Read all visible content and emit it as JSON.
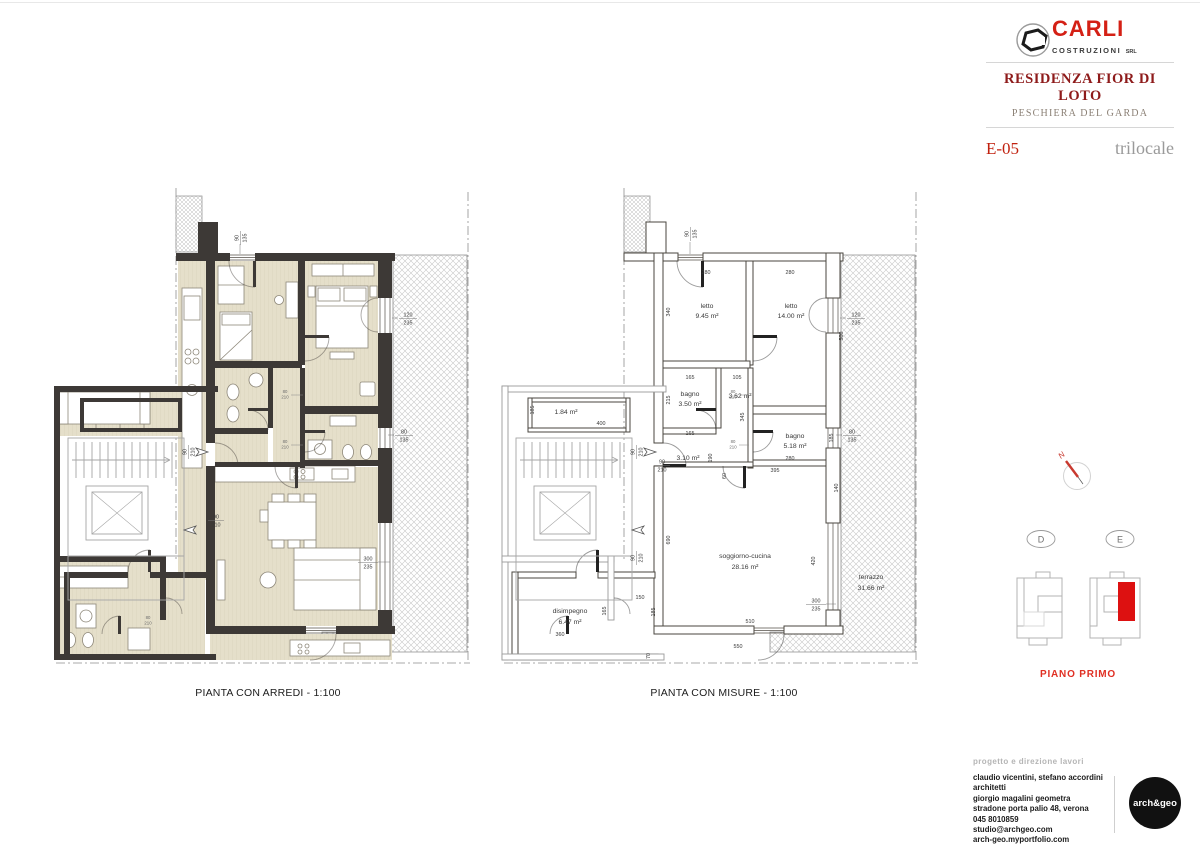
{
  "header": {
    "brand": "CARLI",
    "brand_sub": "COSTRUZIONI",
    "brand_suffix": "SRL",
    "residence": "RESIDENZA FIOR DI LOTO",
    "location": "PESCHIERA DEL GARDA",
    "unit_code": "E-05",
    "unit_type": "trilocale"
  },
  "plans": {
    "arredi": {
      "caption": "PIANTA CON ARREDI - 1:100"
    },
    "misure": {
      "caption": "PIANTA CON MISURE - 1:100",
      "rooms": [
        {
          "name": "letto",
          "area": "9.45 m²"
        },
        {
          "name": "letto",
          "area": "14.00 m²"
        },
        {
          "name": "bagno",
          "area": "3.50 m²"
        },
        {
          "name": "",
          "area": "3.62 m²"
        },
        {
          "name": "bagno",
          "area": "5.18 m²"
        },
        {
          "name": "",
          "area": "3.10 m²"
        },
        {
          "name": "",
          "area": "1.84 m²"
        },
        {
          "name": "soggiorno-cucina",
          "area": "28.16 m²"
        },
        {
          "name": "disimpegno",
          "area": "6.47 m²"
        },
        {
          "name": "terrazzo",
          "area": "31.66 m²"
        }
      ],
      "lin": {
        "letto1_w": "280",
        "letto2_w": "280",
        "letto1_d": "340",
        "letto2_d": "500",
        "bagno1_w": "165",
        "bagno1_d": "215",
        "corr_w": "105",
        "corr_d": "345",
        "bagno2_w": "280",
        "bagno2_d": "185",
        "hall_w": "165",
        "hall_d": "190",
        "seg60": "60",
        "living_top": "395",
        "living_d": "690",
        "living_w": "510",
        "living_ow": "550",
        "rip_d": "185",
        "rip_w": "400",
        "dis_w": "360",
        "dis_d": "165",
        "seg150": "150",
        "seg185": "185",
        "terr_d": "420",
        "seg140": "140",
        "seg70": "70"
      }
    }
  },
  "od": {
    "d90_135": [
      "90",
      "135"
    ],
    "d120_235": [
      "120",
      "235"
    ],
    "d80_135": [
      "80",
      "135"
    ],
    "d300_235": [
      "300",
      "235"
    ],
    "d90_210": [
      "90",
      "210"
    ],
    "d80_210": [
      "80",
      "210"
    ]
  },
  "keyplan": {
    "north": "N",
    "building_d": "D",
    "building_e": "E",
    "floor": "PIANO PRIMO"
  },
  "footer": {
    "label": "progetto e direzione lavori",
    "lines": [
      "claudio vicentini, stefano accordini architetti",
      "giorgio magalini geometra",
      "stradone porta palio 48, verona",
      "045 8010859",
      "studio@archgeo.com",
      "arch-geo.myportfolio.com"
    ],
    "logo": "arch&geo"
  },
  "colors": {
    "accent_red": "#d42015",
    "title_maroon": "#8e1b1b",
    "wall_dark": "#3d3936",
    "floor_beige": "#e5dfca",
    "highlight_red": "#dd1111"
  }
}
